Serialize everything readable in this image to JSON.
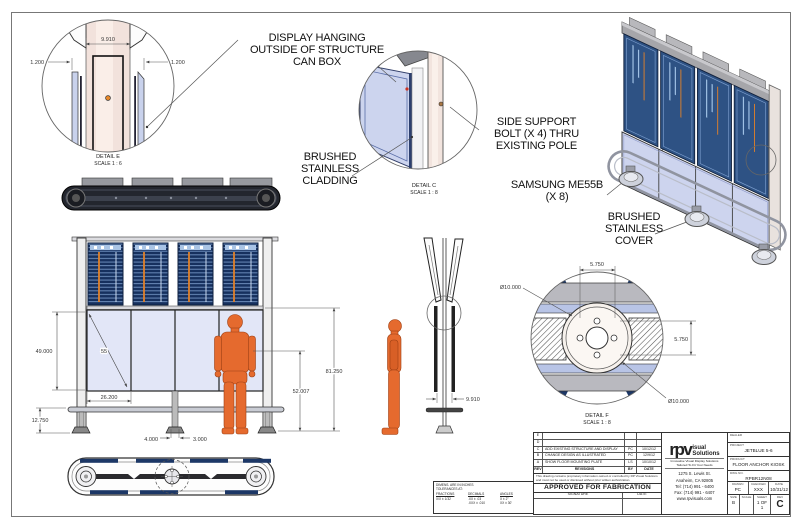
{
  "callouts": {
    "display_hanging": "DISPLAY HANGING\nOUTSIDE OF STRUCTURE\nCAN BOX",
    "side_support": "SIDE SUPPORT\nBOLT (X 4) THRU\nEXISTING POLE",
    "brushed_cladding": "BRUSHED\nSTAINLESS\nCLADDING",
    "samsung": "SAMSUNG ME55B\n(X 8)",
    "brushed_cover": "BRUSHED\nSTAINLESS\nCOVER"
  },
  "detail_e": {
    "title": "DETAIL E",
    "scale": "SCALE 1 : 6",
    "dim_width": "9.910",
    "dim_left": "1.200",
    "dim_right": "1.200"
  },
  "detail_c": {
    "title": "DETAIL C",
    "scale": "SCALE 1 : 8"
  },
  "detail_f": {
    "title": "DETAIL F",
    "scale": "SCALE 1 : 8",
    "dim_top": "5.750",
    "dim_right": "5.750",
    "dia_top": "Ø10.000",
    "dia_bottom": "Ø10.000"
  },
  "front_view": {
    "dim_panel_height": "49.000",
    "dim_diag": "55",
    "dim_panel_width": "26.200",
    "dim_base": "12.750",
    "dim_foot_left": "4.000",
    "dim_foot_right": "3.000",
    "dim_mid": "52.007",
    "dim_total": "81.250"
  },
  "side_view": {
    "dim_width": "9.910"
  },
  "title_block": {
    "revisions": [
      {
        "rev": "E",
        "desc": "",
        "by": "",
        "date": ""
      },
      {
        "rev": "D",
        "desc": "",
        "by": "",
        "date": ""
      },
      {
        "rev": "C",
        "desc": "ADD EXISTING STRUCTURE AND DISPLAY",
        "by": "PC",
        "date": "10/12/12"
      },
      {
        "rev": "B",
        "desc": "CHANGE DESIGN AS ILLUSTRATED",
        "by": "PC",
        "date": "12/9/12"
      },
      {
        "rev": "A",
        "desc": "SHOW FLOOR MOUNTING PLATE",
        "by": "LS",
        "date": "10/10/12"
      }
    ],
    "rev_header": {
      "rev": "REV",
      "desc": "REVISIONS",
      "by": "BY",
      "date": "DATE"
    },
    "disclaimer": "This drawing contains proprietary information owned or controlled by RP Visual Solutions and must not be used or disclosed without prior written authorization.",
    "approved": "APPROVED FOR FABRICATION",
    "signature_label": "SIGNATURE",
    "date_label": "DATE",
    "logo_rpv": "rpv",
    "logo_visual": "isual",
    "logo_solutions": "Solutions",
    "tagline": "Innovative Visual Display Solutions\nTailored To Fit Your Needs",
    "address": "1275 S. Lewis St.\nAnaheim, CA 92805\nTel: (714) 991 - 6400\nFax: (714) 991 - 6407\nwww.rpvisuals.com",
    "dealer_label": "DEALER",
    "project_label": "PROJECT",
    "project_value": "JETBLUE 5-6",
    "product_label": "PRODUCT",
    "product_value": "FLOOR ANCHOR KIOSK",
    "dwg_label": "DWG NO.",
    "dwg_value": "RPBR12N08",
    "drawn_label": "DRAWN",
    "drawn_value": "PC",
    "checked_label": "CHECKED",
    "checked_value": "XXX",
    "date2_label": "DATE",
    "date2_value": "10/31/12",
    "size_label": "SIZE",
    "size_value": "B",
    "scale_label": "SCALE",
    "scale_value": "",
    "sheet_label": "SHEET",
    "sheet_value": "1 OF 1",
    "rev_label": "REV",
    "rev_value": "C"
  },
  "tolerance_block": {
    "header": "DIMENS. ARE IN INCHES\nTOLERANCES AT:",
    "fractions_label": "FRACTIONS",
    "fractions_value": "X/X ± 1/32",
    "decimals_label": "DECIMALS",
    "decimals_value": ".XX ± .03\n.XXX ± .010",
    "angles_label": "ANGLES",
    "angles_value": "X ± 2°\nXX ± 30'"
  },
  "colors": {
    "screen_navy": "#16305e",
    "screen_rows": "#7d9fcf",
    "panel_lavender": "#d9def2",
    "pole_pink": "#f2e2dc",
    "figure_orange": "#e56a2e",
    "accent_orange": "#e0812a"
  }
}
